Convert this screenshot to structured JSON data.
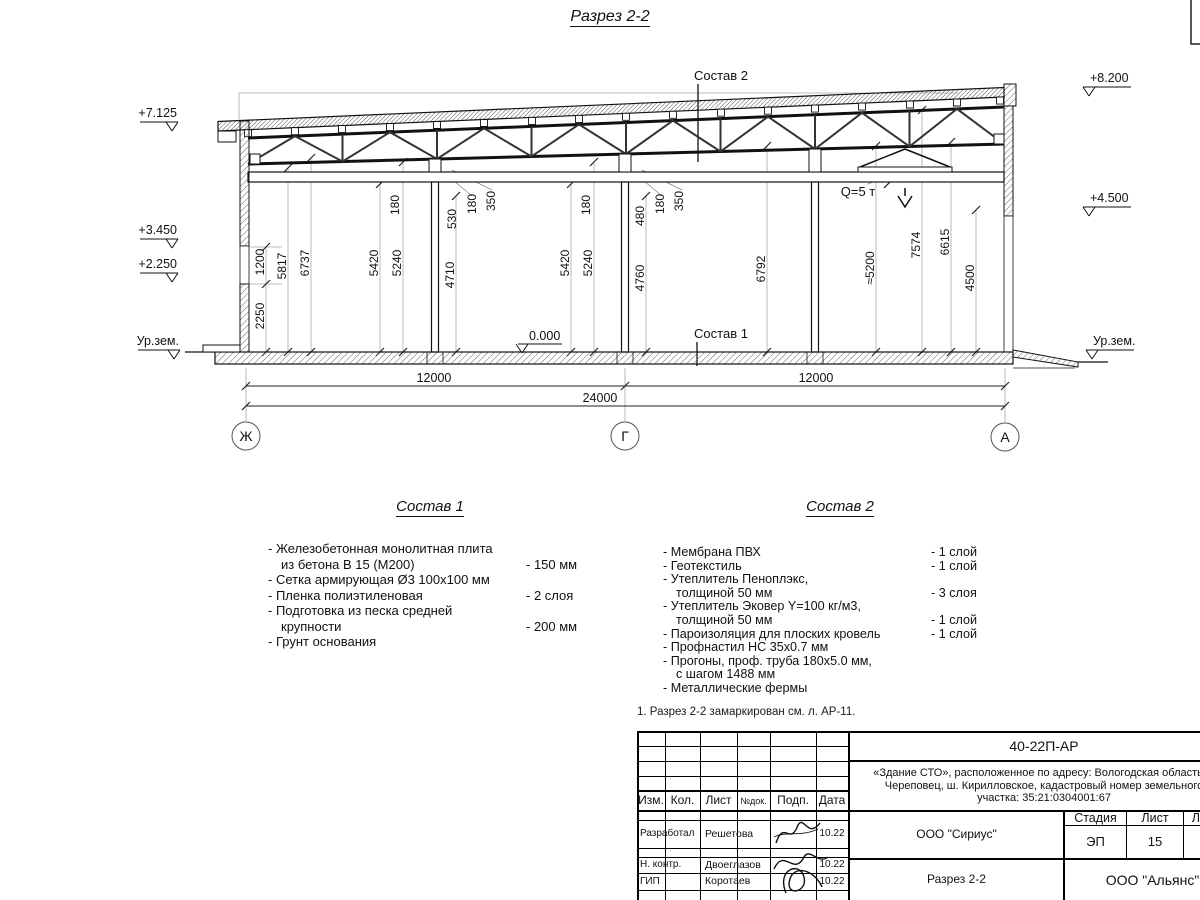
{
  "page_title": "Разрез 2-2",
  "drawing": {
    "elev_left": [
      "+7.125",
      "+3.450",
      "+2.250",
      "Ур.зем."
    ],
    "elev_right": [
      "+8.200",
      "+4.500",
      "Ур.зем."
    ],
    "zero_mark": "0.000",
    "hoist_label": "Q=5 т",
    "layer_ref_top": "Состав 2",
    "layer_ref_floor": "Состав 1",
    "vdims": [
      "1200",
      "2250",
      "5817",
      "6737",
      "180",
      "5420",
      "5240",
      "530",
      "180",
      "350",
      "4710",
      "5420",
      "5240",
      "180",
      "480",
      "180",
      "350",
      "4760",
      "6792",
      "≈5200",
      "7574",
      "6615",
      "4500"
    ],
    "hdims": [
      "12000",
      "12000",
      "24000"
    ],
    "axes": [
      "Ж",
      "Г",
      "А"
    ]
  },
  "sostav1": {
    "title": "Состав 1",
    "rows": [
      {
        "text": "- Железобетонная  монолитная плита",
        "value": ""
      },
      {
        "text": "из бетона В 15 (М200)",
        "value": "- 150 мм"
      },
      {
        "text": "- Сетка армирующая Ø3 100х100 мм",
        "value": ""
      },
      {
        "text": "- Пленка полиэтиленовая",
        "value": "-  2 слоя"
      },
      {
        "text": "- Подготовка из песка средней",
        "value": ""
      },
      {
        "text": "крупности",
        "value": "- 200 мм"
      },
      {
        "text": "- Грунт основания",
        "value": ""
      }
    ]
  },
  "sostav2": {
    "title": "Состав 2",
    "rows": [
      {
        "text": "- Мембрана ПВХ",
        "value": "- 1 слой"
      },
      {
        "text": "- Геотекстиль",
        "value": "- 1 слой"
      },
      {
        "text": "- Утеплитель Пеноплэкс,",
        "value": ""
      },
      {
        "text": "толщиной 50 мм",
        "value": "- 3 слоя"
      },
      {
        "text": "- Утеплитель Эковер Y=100 кг/м3,",
        "value": ""
      },
      {
        "text": "толщиной 50 мм",
        "value": "- 1 слой"
      },
      {
        "text": "- Пароизоляция для плоских кровель",
        "value": "- 1 слой"
      },
      {
        "text": "- Профнастил НС 35х0.7 мм",
        "value": ""
      },
      {
        "text": "- Прогоны, проф. труба 180х5.0 мм,",
        "value": ""
      },
      {
        "text": "с шагом 1488 мм",
        "value": ""
      },
      {
        "text": "- Металлические фермы",
        "value": ""
      }
    ]
  },
  "note": "1. Разрез 2-2 замаркирован см. л. АР-11.",
  "titleblock": {
    "doc_number": "40-22П-АР",
    "project": "«Здание СТО», расположенное по адресу: Вологодская область, г. Череповец, ш. Кирилловское, кадастровый номер земельного участка: 35:21:0304001:67",
    "header": [
      "Изм.",
      "Кол.",
      "Лист",
      "№док.",
      "Подп.",
      "Дата"
    ],
    "rows": [
      {
        "role": "Разработал",
        "name": "Решетова",
        "date": "10.22"
      },
      {
        "role": "Н. контр.",
        "name": "Двоеглазов",
        "date": "10.22"
      },
      {
        "role": "ГИП",
        "name": "Коротаев",
        "date": "10.22"
      }
    ],
    "org1": "ООО \"Сириус\"",
    "stage_label": "Стадия",
    "sheet_label": "Лист",
    "sheets_label": "Листов",
    "stage": "ЭП",
    "sheet": "15",
    "sheets": "16",
    "drawing_name": "Разрез 2-2",
    "org2": "ООО \"Альянс\""
  }
}
